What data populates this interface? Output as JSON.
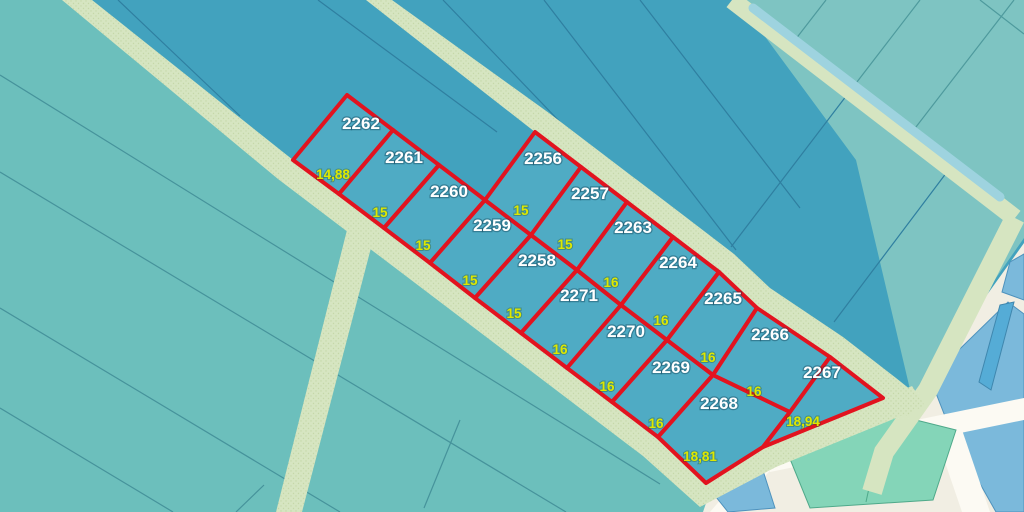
{
  "map": {
    "parcels": [
      {
        "number": "2262"
      },
      {
        "number": "2261"
      },
      {
        "number": "2260"
      },
      {
        "number": "2259"
      },
      {
        "number": "2258"
      },
      {
        "number": "2271"
      },
      {
        "number": "2270"
      },
      {
        "number": "2269"
      },
      {
        "number": "2268"
      },
      {
        "number": "2256"
      },
      {
        "number": "2257"
      },
      {
        "number": "2263"
      },
      {
        "number": "2264"
      },
      {
        "number": "2265"
      },
      {
        "number": "2266"
      },
      {
        "number": "2267"
      }
    ],
    "measurements_road_side": [
      "14,88",
      "15",
      "15",
      "15",
      "15",
      "16",
      "16",
      "16",
      "18,81"
    ],
    "measurements_seam_side": [
      "15",
      "15",
      "16",
      "16",
      "16",
      "16",
      "18,94"
    ],
    "colors": {
      "red_boundary": "#E2131F",
      "block_parcel_fill": "#4FABC4",
      "parcel_number_text": "#FFFFFF",
      "measurement_text": "#DEE800",
      "field_dark": "#42A2BE",
      "field_light": "#6CBFBC",
      "field_muted": "#7EC4C2",
      "road": "#D6E5C1",
      "road_dot": "#C5D8A8",
      "canal": "#9ED3DF",
      "cream": "#F1EEE3",
      "road_white": "#FCFAF3",
      "urban_blue": "#7BB9DB",
      "urban_blue_dark": "#55ACD6",
      "urban_mint": "#84D5B8",
      "line_dark": "#2F7FA0",
      "line_light": "#46939B",
      "line_muted": "#4E9A9D"
    }
  }
}
